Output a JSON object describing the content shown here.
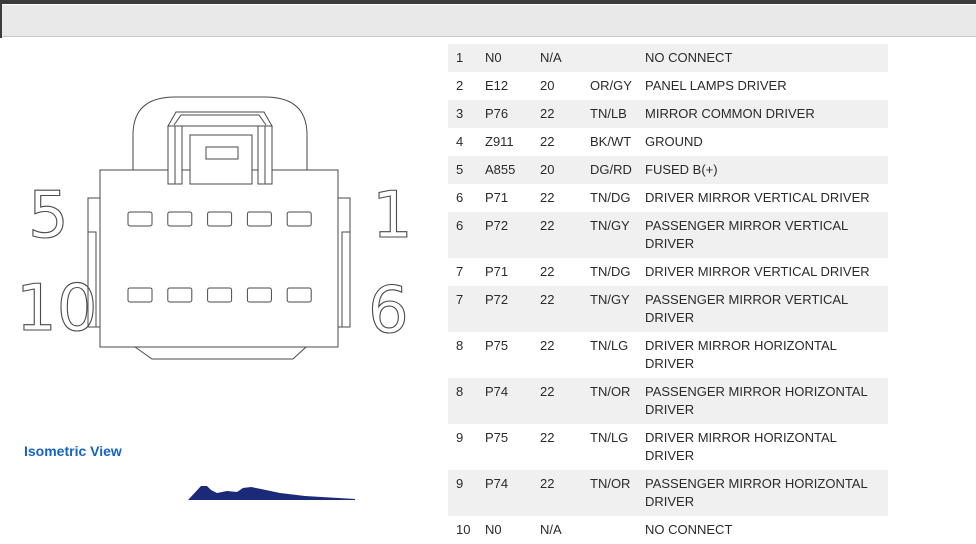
{
  "diagram": {
    "pin_labels": {
      "top_left": "5",
      "bottom_left": "10",
      "top_right": "1",
      "bottom_right": "6"
    }
  },
  "isometric": {
    "label": "Isometric View"
  },
  "table": {
    "rows": [
      {
        "pin": "1",
        "circuit": "N0",
        "gauge": "N/A",
        "color": "",
        "function": "NO CONNECT"
      },
      {
        "pin": "2",
        "circuit": "E12",
        "gauge": "20",
        "color": "OR/GY",
        "function": "PANEL LAMPS DRIVER"
      },
      {
        "pin": "3",
        "circuit": "P76",
        "gauge": "22",
        "color": "TN/LB",
        "function": "MIRROR COMMON DRIVER"
      },
      {
        "pin": "4",
        "circuit": "Z911",
        "gauge": "22",
        "color": "BK/WT",
        "function": "GROUND"
      },
      {
        "pin": "5",
        "circuit": "A855",
        "gauge": "20",
        "color": "DG/RD",
        "function": "FUSED B(+)"
      },
      {
        "pin": "6",
        "circuit": "P71",
        "gauge": "22",
        "color": "TN/DG",
        "function": "DRIVER MIRROR VERTICAL DRIVER"
      },
      {
        "pin": "6",
        "circuit": "P72",
        "gauge": "22",
        "color": "TN/GY",
        "function": "PASSENGER MIRROR VERTICAL\nDRIVER"
      },
      {
        "pin": "7",
        "circuit": "P71",
        "gauge": "22",
        "color": "TN/DG",
        "function": "DRIVER MIRROR VERTICAL DRIVER"
      },
      {
        "pin": "7",
        "circuit": "P72",
        "gauge": "22",
        "color": "TN/GY",
        "function": "PASSENGER MIRROR VERTICAL\nDRIVER"
      },
      {
        "pin": "8",
        "circuit": "P75",
        "gauge": "22",
        "color": "TN/LG",
        "function": "DRIVER MIRROR HORIZONTAL DRIVER"
      },
      {
        "pin": "8",
        "circuit": "P74",
        "gauge": "22",
        "color": "TN/OR",
        "function": "PASSENGER MIRROR HORIZONTAL\nDRIVER"
      },
      {
        "pin": "9",
        "circuit": "P75",
        "gauge": "22",
        "color": "TN/LG",
        "function": "DRIVER MIRROR HORIZONTAL DRIVER"
      },
      {
        "pin": "9",
        "circuit": "P74",
        "gauge": "22",
        "color": "TN/OR",
        "function": "PASSENGER MIRROR HORIZONTAL\nDRIVER"
      },
      {
        "pin": "10",
        "circuit": "N0",
        "gauge": "N/A",
        "color": "",
        "function": "NO CONNECT"
      }
    ]
  },
  "colors": {
    "accent_blue": "#1565c0",
    "thumbnail_navy": "#1b2a78",
    "row_stripe": "#f0f0f0",
    "chrome_dark": "#3b3b3b"
  }
}
